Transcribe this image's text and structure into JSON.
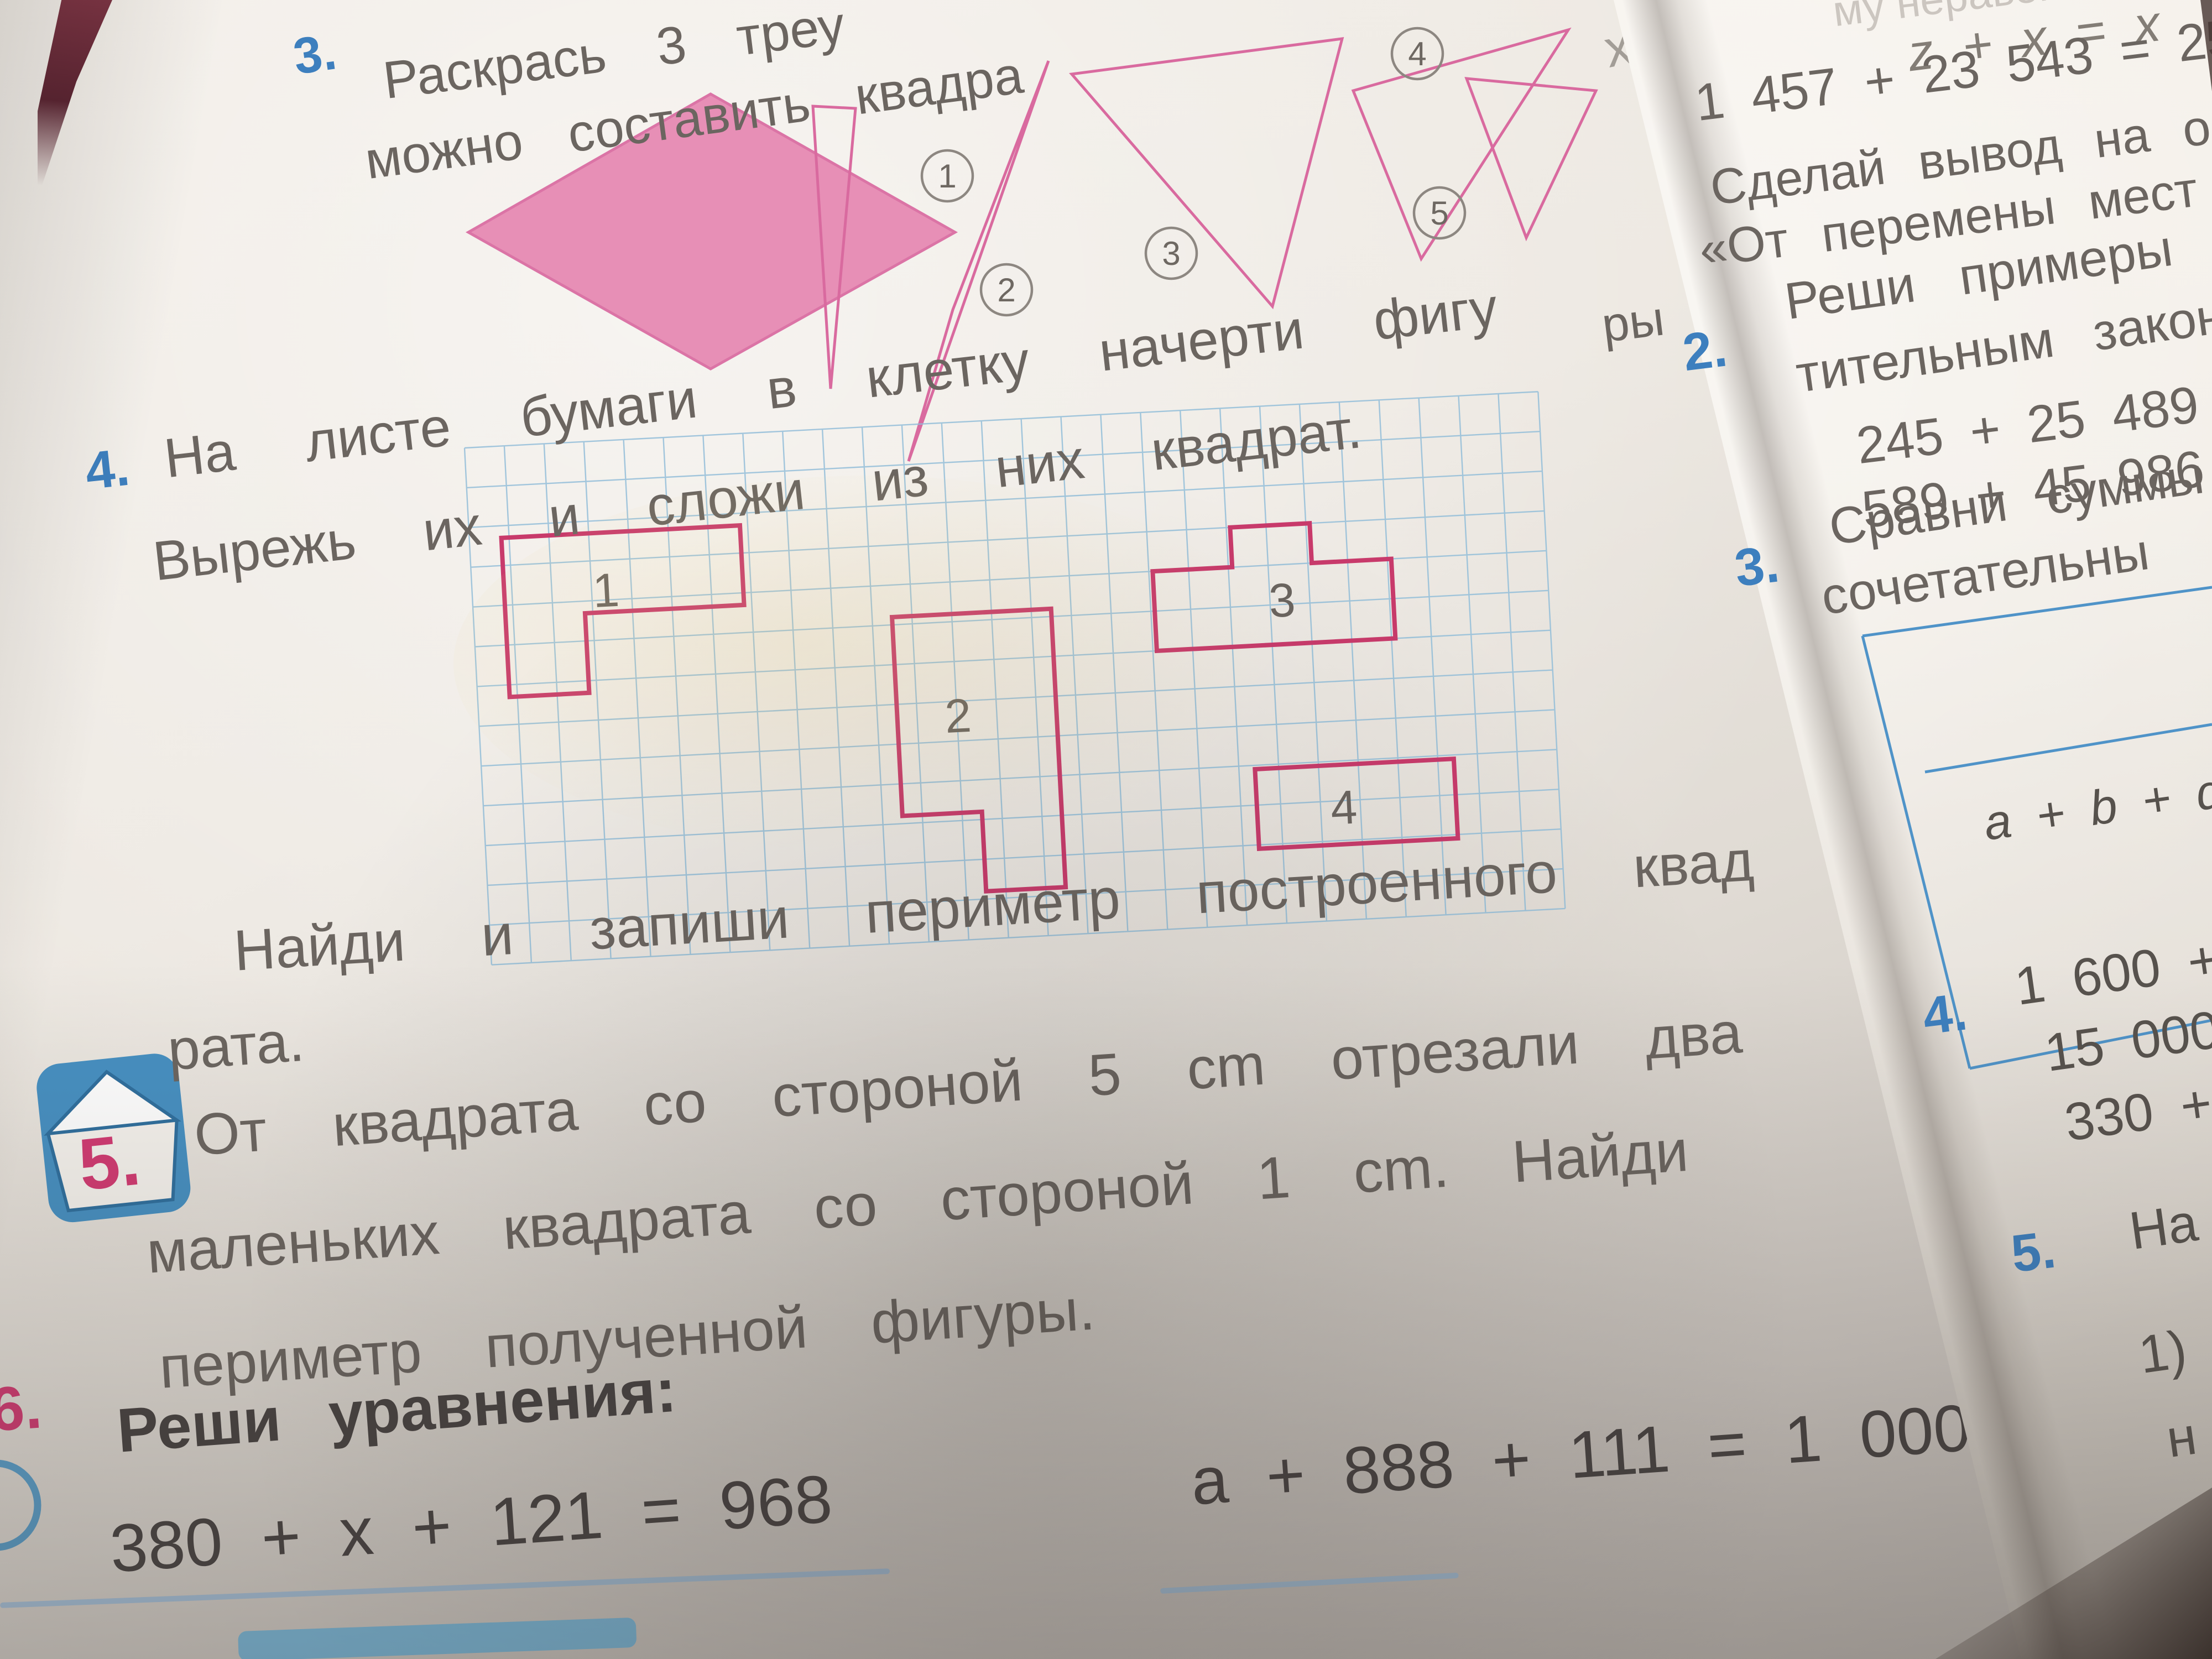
{
  "page_left": {
    "task3": {
      "number": "3.",
      "line1": "Раскрась 3 треу",
      "line2": "можно составить квадра",
      "markers": [
        "1",
        "2",
        "3",
        "4",
        "5"
      ]
    },
    "task4": {
      "number": "4.",
      "line1": "На листе бумаги в клетку начерти фигу",
      "line1_tail": "ры",
      "line2": "Вырежь их и сложи из них квадрат.",
      "figure_labels": [
        "1",
        "2",
        "3",
        "4"
      ]
    },
    "perimeter_line1": "Найди и запиши периметр построенного квад",
    "perimeter_line2": "рата.",
    "task5": {
      "number": "5.",
      "line1": "От квадрата со стороной 5 cm отрезали два",
      "line2": "маленьких квадрата со стороной 1 cm. Найди",
      "line3": "периметр полученной фигуры."
    },
    "task6": {
      "number": "6.",
      "title": "Реши уравнения:",
      "eq1": "380 + x + 121 = 968",
      "eq2": "a + 888 + 111 = 1 000"
    },
    "stray_mark": "х"
  },
  "page_right": {
    "faint_top": "му неравен",
    "eq_letters": "z + x = x",
    "eq_sum": "1 457 + 23 543 = 25 000",
    "note_line1": "Сделай вывод на ос",
    "note_line2": "«От перемены мест",
    "task2": {
      "number": "2.",
      "line1": "Реши примеры сто",
      "line2": "тительным законо",
      "ex1": "245 + 25 489",
      "ex2": "589 + 45 986"
    },
    "task3": {
      "number": "3.",
      "line1": "Сравни суммы",
      "line2": "сочетательны",
      "formula": "a + b + d ="
    },
    "task4": {
      "number": "4.",
      "ex1": "1 600 +",
      "ex2": "15 000",
      "ex3": "330 +"
    },
    "task5": {
      "number": "5.",
      "line1": "На",
      "item1": "1)",
      "item2": "н"
    }
  },
  "colors": {
    "task_number_blue": "#3d7fbe",
    "task_number_pink": "#d23a72",
    "print_gray": "#6b6560",
    "figure_outline_pink": "#c83a6b",
    "shape_fill_pink": "#e78fb6",
    "grid_blue": "#92bdd8",
    "table_blue": "#4f93c8",
    "underline_blue": "#a6c6e2",
    "house_icon_blue": "#4690c2"
  }
}
